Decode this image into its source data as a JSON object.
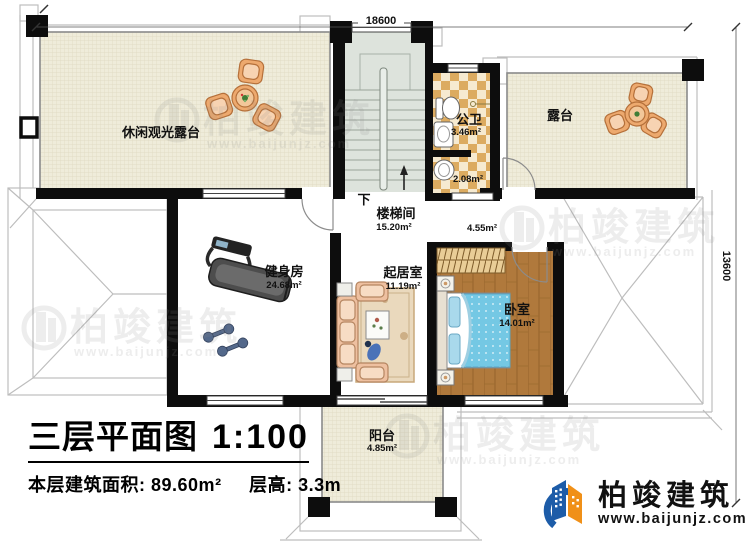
{
  "header": {
    "dim_top": "18600",
    "dim_right": "13600"
  },
  "rooms": {
    "leisure_terrace": {
      "name": "休闲观光露台"
    },
    "terrace": {
      "name": "露台"
    },
    "bathroom": {
      "name": "公卫",
      "area": "3.46m²"
    },
    "bathroom_lobby": {
      "area": "2.08m²"
    },
    "stairwell": {
      "name": "楼梯间",
      "area": "15.20m²",
      "direction": "下"
    },
    "hall": {
      "area": "4.55m²"
    },
    "gym": {
      "name": "健身房",
      "area": "24.68m²"
    },
    "living_room": {
      "name": "起居室",
      "area": "11.19m²"
    },
    "bedroom": {
      "name": "卧室",
      "area": "14.01m²"
    },
    "balcony": {
      "name": "阳台",
      "area": "4.85m²"
    }
  },
  "title_block": {
    "title": "三层平面图",
    "scale": "1:100",
    "area_label": "本层建筑面积:",
    "area_value": "89.60m²",
    "floor_height_label": "层高:",
    "floor_height_value": "3.3m"
  },
  "branding": {
    "company": "柏竣建筑",
    "website": "www.baijunjz.com"
  },
  "watermark": {
    "company": "柏竣建筑",
    "website": "www.baijunjz.com"
  },
  "colors": {
    "wall": "#0d0d0d",
    "terrace_fill": "#efecda",
    "stair_fill": "#dde3dc",
    "checker_dark": "#dcab60",
    "checker_light": "#f6ead0",
    "wood": "#b0793c",
    "bed_blue": "#74c8e4",
    "sofa_peach": "#eec0a0",
    "logo_blue": "#1d5ca8",
    "logo_orange": "#f09018"
  }
}
